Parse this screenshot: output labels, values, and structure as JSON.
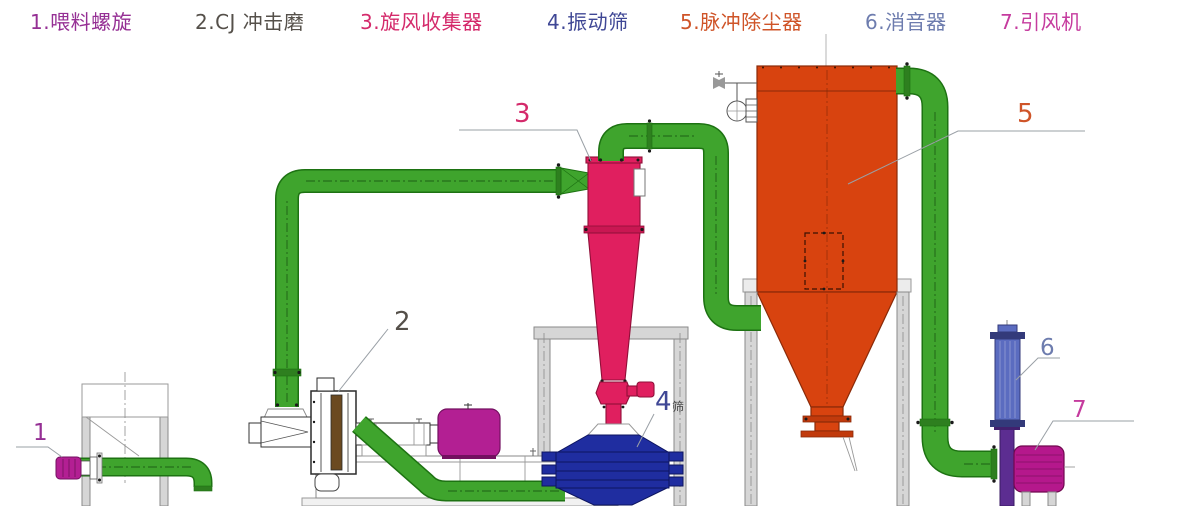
{
  "palette": {
    "bg": "#ffffff",
    "c1": "#952f94",
    "c2": "#55504a",
    "c3": "#d42a6b",
    "c4": "#3f4795",
    "c5": "#cf5428",
    "c6": "#6d7cae",
    "c7": "#c53b9e",
    "pipe_fill": "#3fa42d",
    "pipe_edge": "#1d7212",
    "pipe_dark": "#2e7f1f",
    "pipe_center": "#14490d",
    "cyclone": "#e01f5f",
    "cyclone_edge": "#8f0f38",
    "collector": "#d8430f",
    "collector_edge": "#8a2a08",
    "screen_blue": "#1f2da0",
    "screen_edge": "#0d1560",
    "muffler": "#5b6cc0",
    "muffler_edge": "#333a7a",
    "duct_purple": "#5c2d91",
    "motor_magenta": "#b31f93",
    "motor_edge": "#731060",
    "fan_magenta": "#b5188c",
    "frame_gray": "#d6d6d6",
    "frame_edge": "#8a8a8a",
    "leader": "#9aa0a6"
  },
  "legend": {
    "items": [
      {
        "label": "1.喂料螺旋"
      },
      {
        "label": "2.CJ 冲击磨"
      },
      {
        "label": "3.旋风收集器"
      },
      {
        "label": "4.振动筛"
      },
      {
        "label": "5.脉冲除尘器"
      },
      {
        "label": "6.消音器"
      },
      {
        "label": "7.引风机"
      }
    ]
  },
  "callouts": [
    {
      "num": "1"
    },
    {
      "num": "2"
    },
    {
      "num": "3"
    },
    {
      "num": "4",
      "suffix": "筛"
    },
    {
      "num": "5"
    },
    {
      "num": "6"
    },
    {
      "num": "7"
    }
  ]
}
